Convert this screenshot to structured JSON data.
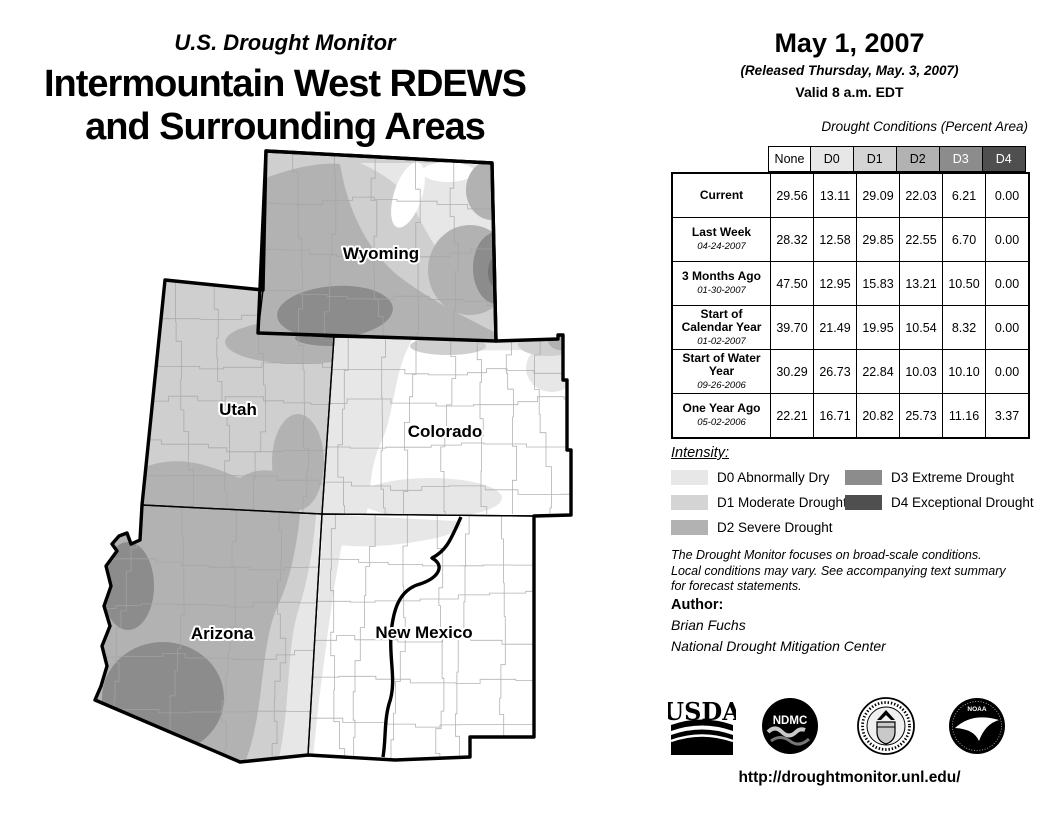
{
  "header": {
    "monitor_title": "U.S. Drought Monitor",
    "region_line1": "Intermountain West RDEWS",
    "region_line2": "and Surrounding Areas"
  },
  "date_block": {
    "date": "May 1, 2007",
    "released": "(Released Thursday, May. 3, 2007)",
    "valid": "Valid 8 a.m. EDT"
  },
  "table": {
    "caption": "Drought Conditions (Percent Area)",
    "columns": [
      "None",
      "D0",
      "D1",
      "D2",
      "D3",
      "D4"
    ],
    "rows": [
      {
        "label": "Current",
        "date": "",
        "values": [
          "29.56",
          "13.11",
          "29.09",
          "22.03",
          "6.21",
          "0.00"
        ]
      },
      {
        "label": "Last Week",
        "date": "04-24-2007",
        "values": [
          "28.32",
          "12.58",
          "29.85",
          "22.55",
          "6.70",
          "0.00"
        ]
      },
      {
        "label": "3 Months Ago",
        "date": "01-30-2007",
        "values": [
          "47.50",
          "12.95",
          "15.83",
          "13.21",
          "10.50",
          "0.00"
        ]
      },
      {
        "label": "Start of Calendar Year",
        "date": "01-02-2007",
        "values": [
          "39.70",
          "21.49",
          "19.95",
          "10.54",
          "8.32",
          "0.00"
        ]
      },
      {
        "label": "Start of Water Year",
        "date": "09-26-2006",
        "values": [
          "30.29",
          "26.73",
          "22.84",
          "10.03",
          "10.10",
          "0.00"
        ]
      },
      {
        "label": "One Year Ago",
        "date": "05-02-2006",
        "values": [
          "22.21",
          "16.71",
          "20.82",
          "25.73",
          "11.16",
          "3.37"
        ]
      }
    ]
  },
  "legend": {
    "heading": "Intensity:",
    "items": [
      {
        "code": "D0",
        "label": "D0 Abnormally Dry",
        "color": "#e7e7e7"
      },
      {
        "code": "D1",
        "label": "D1 Moderate Drought",
        "color": "#d4d4d4"
      },
      {
        "code": "D2",
        "label": "D2 Severe Drought",
        "color": "#b2b2b2"
      },
      {
        "code": "D3",
        "label": "D3 Extreme Drought",
        "color": "#8c8c8c"
      },
      {
        "code": "D4",
        "label": "D4 Exceptional Drought",
        "color": "#4f4f4f"
      }
    ]
  },
  "notes": {
    "line1": "The Drought Monitor focuses on broad-scale conditions.",
    "line2": "Local conditions may vary. See accompanying text summary",
    "line3": "for forecast statements."
  },
  "author": {
    "heading": "Author:",
    "name": "Brian Fuchs",
    "org": "National Drought Mitigation Center"
  },
  "footer": {
    "url": "http://droughtmonitor.unl.edu/"
  },
  "logos": {
    "usda": "USDA",
    "ndmc": "NDMC",
    "noaa": "NOAA"
  },
  "map": {
    "labels": [
      "Wyoming",
      "Utah",
      "Colorado",
      "Arizona",
      "New Mexico"
    ],
    "colors": {
      "none": "#ffffff",
      "d0": "#e7e7e7",
      "d1": "#cfcfcf",
      "d2": "#b2b2b2",
      "d3": "#8c8c8c",
      "d4": "#757575"
    }
  }
}
